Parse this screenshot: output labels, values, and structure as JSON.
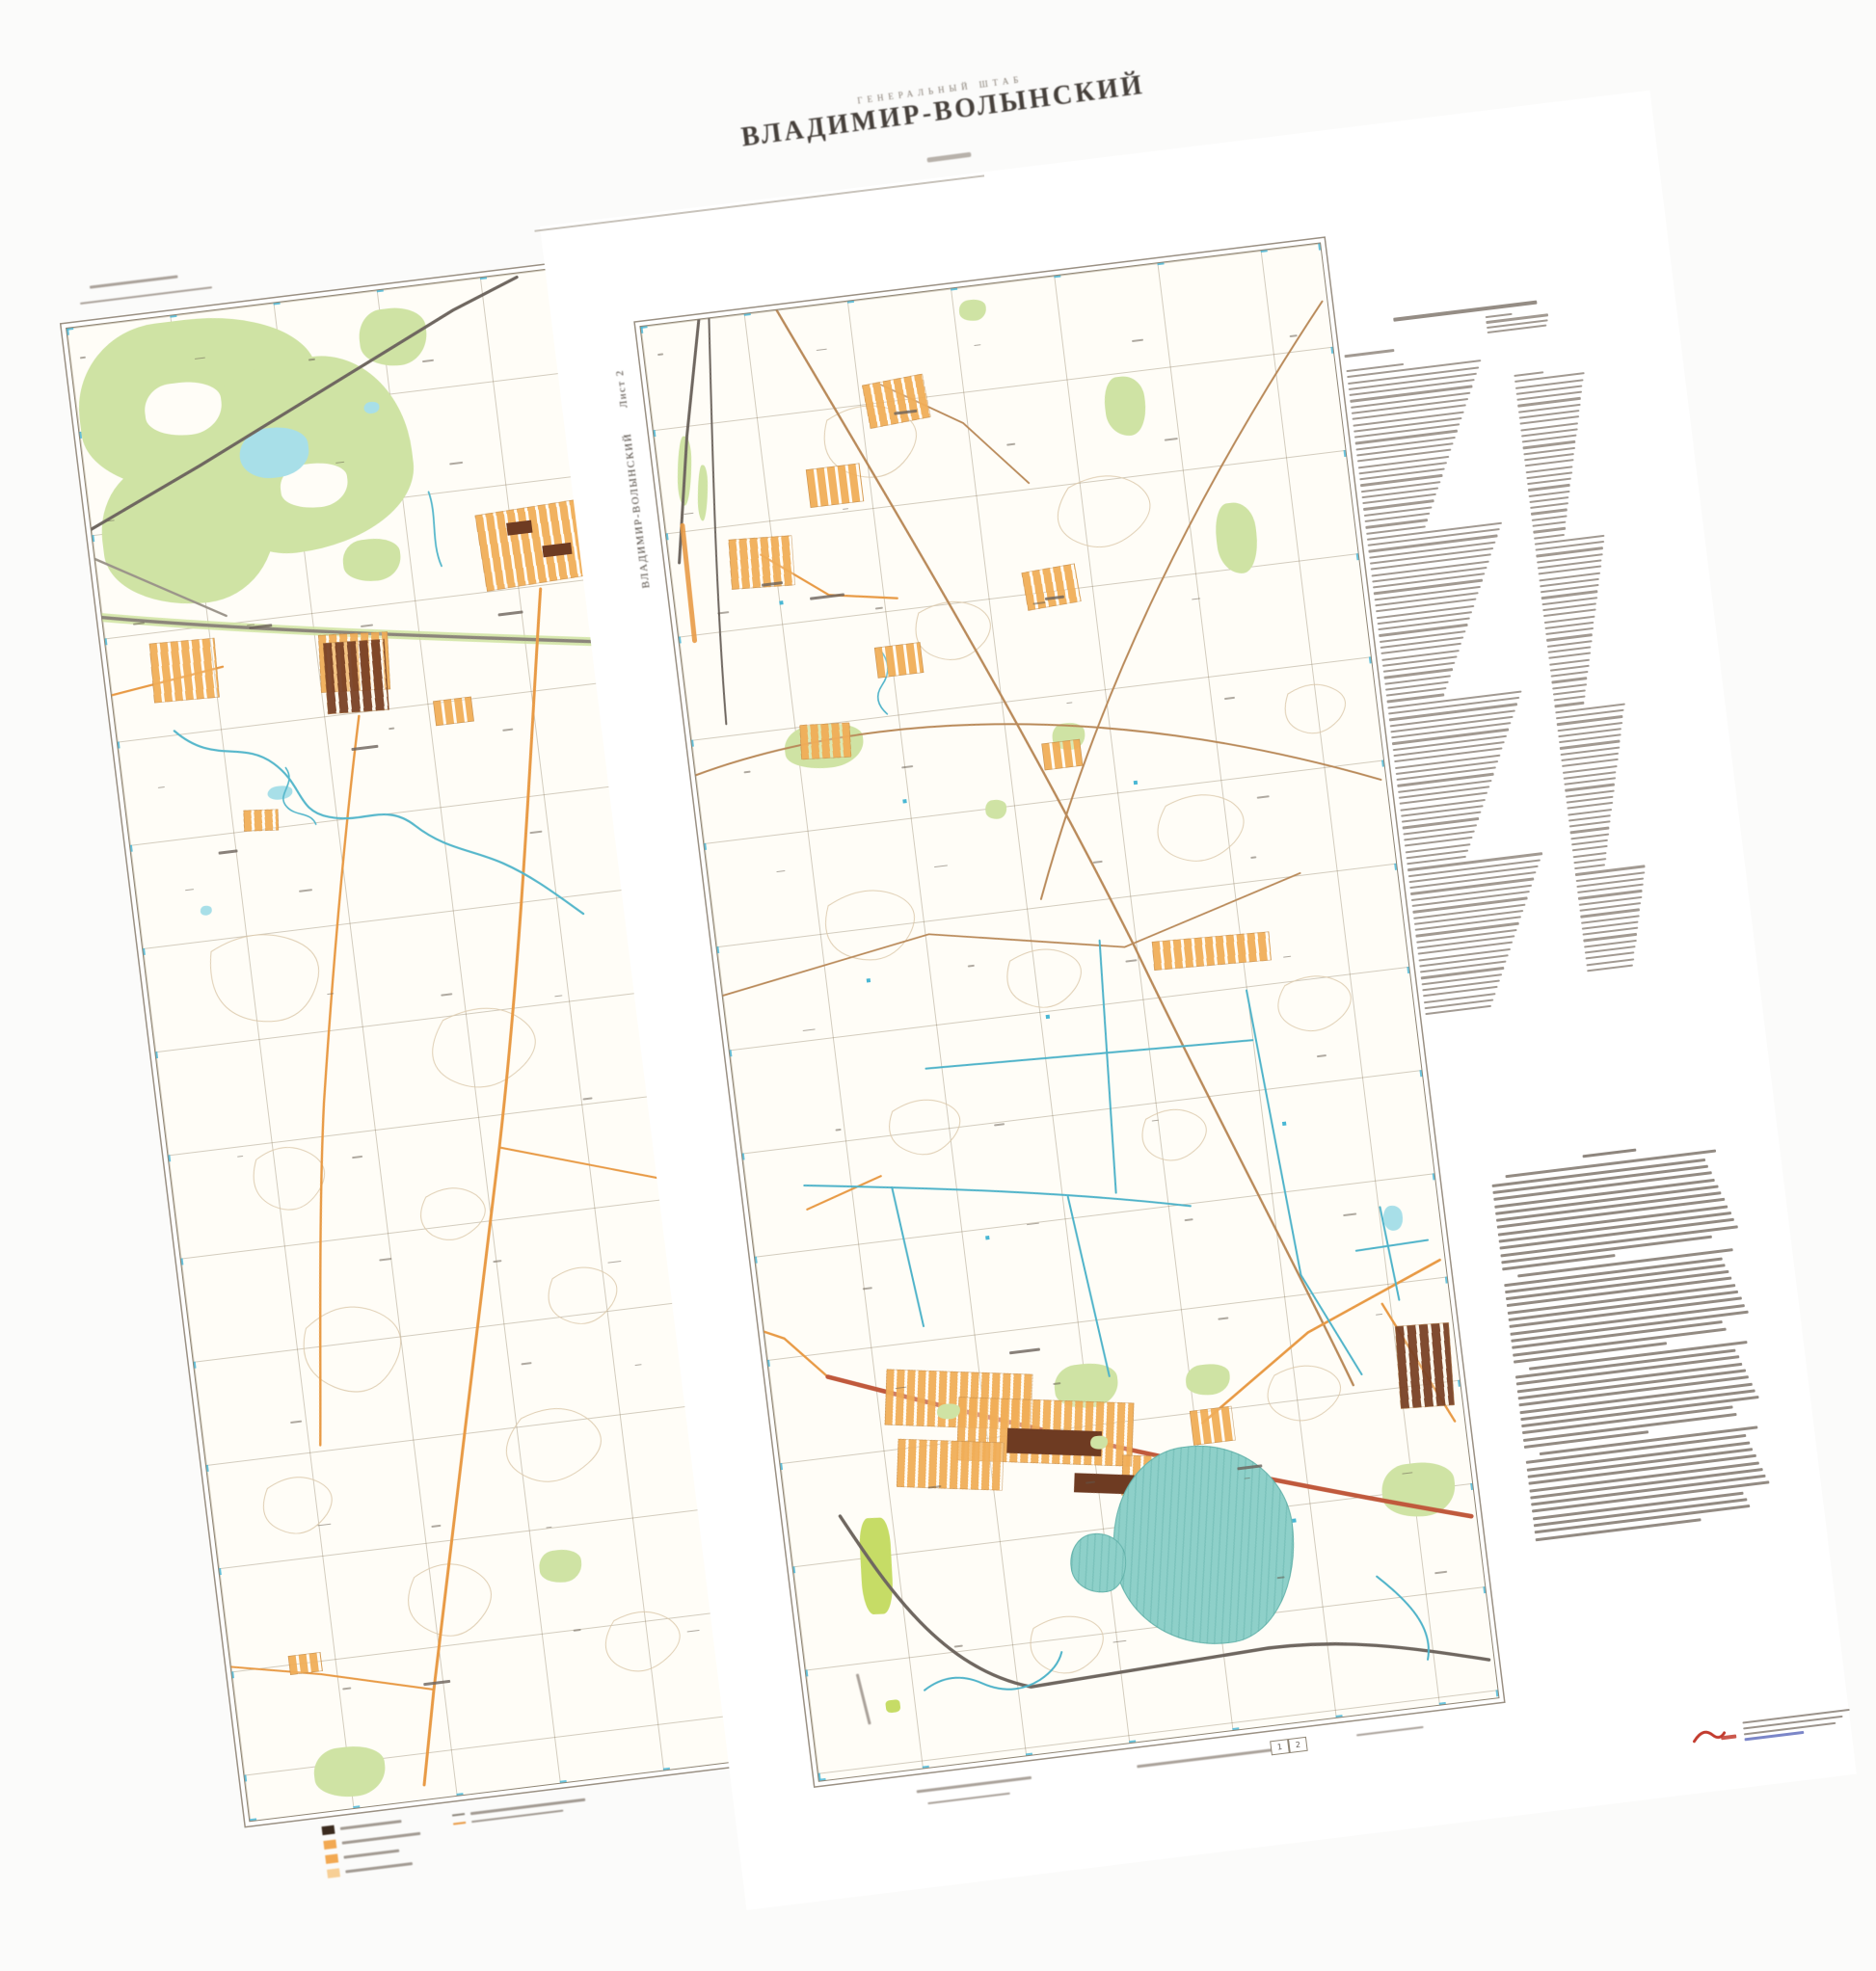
{
  "page": {
    "header_small": "ГЕНЕРАЛЬНЫЙ ШТАБ",
    "title": "ВЛАДИМИР-ВОЛЫНСКИЙ"
  },
  "sheet2": {
    "side_label": "ВЛАДИМИР-ВОЛЫНСКИЙ",
    "side_label_suffix": "Лист 2",
    "adjacency_cells": [
      "1",
      "2"
    ]
  },
  "palette": {
    "paper": "#ffffff",
    "map_background": "#fffdf7",
    "neatline": "#8f8574",
    "forest_green": "#cfe3a4",
    "orchard_green": "#c6dc66",
    "lake_cyan": "#a8dfe8",
    "canal_teal": "#4fb3c9",
    "reservoir_teal": "#8ed0c9",
    "urban_orange": "#f1ae58",
    "urban_dark": "#7a4226",
    "road_orange": "#e89a45",
    "road_red": "#c0593c",
    "railway_gray": "#6f6760",
    "contour_brown": "#dcc9ab",
    "grid_khaki": "#7e6e50",
    "blue_tick": "#45b5d6",
    "logo_red": "#c23b2e",
    "link_blue": "#7b86c8",
    "title_ink": "#46403b"
  }
}
